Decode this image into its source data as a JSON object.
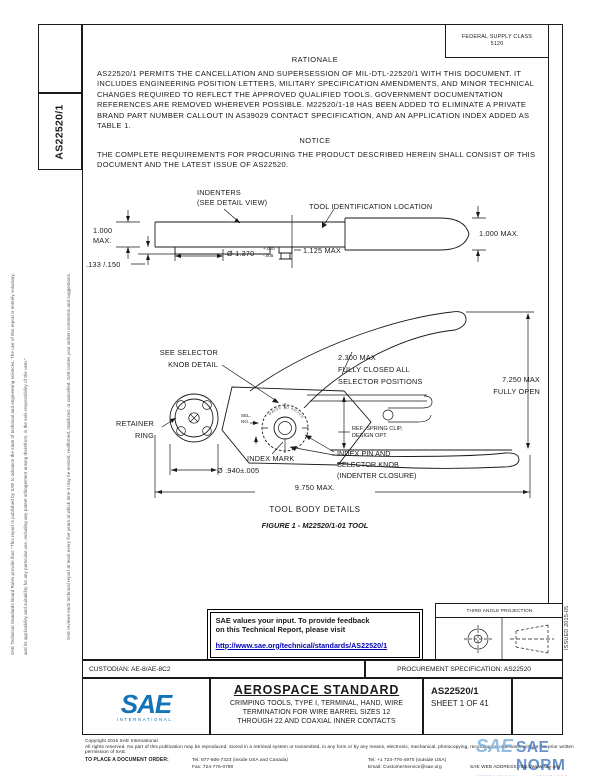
{
  "frame": {
    "fsc": "FEDERAL SUPPLY CLASS\n5120",
    "side_doc_number": "AS22520/1",
    "issued": "ISSUED 2015-05",
    "margin_note_1": "SAE Technical Standards Board Rules provide that: \"This report is published by SAE to advance the state of technical and engineering sciences. The use of this report is entirely voluntary,",
    "margin_note_2": "and its applicability and suitability for any particular use, including any patent infringement arising therefrom, is the sole responsibility of the user.\"",
    "margin_note_3": "SAE reviews each technical report at least every five years at which time it may be revised, reaffirmed, stabilized, or cancelled. SAE invites your written comments and suggestions."
  },
  "rationale": {
    "heading": "RATIONALE",
    "body": "AS22520/1 PERMITS THE CANCELLATION AND SUPERSESSION OF MIL-DTL-22520/1 WITH THIS DOCUMENT.  IT\nINCLUDES ENGINEERING POSITION LETTERS, MILITARY SPECIFICATION AMENDMENTS, AND MINOR TECHNICAL\nCHANGES REQUIRED TO REFLECT THE APPROVED QUALIFIED TOOLS. GOVERNMENT DOCUMENTATION\nREFERENCES ARE REMOVED WHEREVER POSSIBLE. M22520/1-18 HAS BEEN ADDED TO ELIMINATE A PRIVATE\nBRAND PART NUMBER CALLOUT IN AS39029 CONTACT SPECIFICATION, AND AN APPLICATION INDEX ADDED AS\nTABLE 1."
  },
  "notice": {
    "heading": "NOTICE",
    "body": "THE COMPLETE REQUIREMENTS FOR PROCURING THE PRODUCT DESCRIBED HEREIN SHALL CONSIST OF THIS\nDOCUMENT AND THE LATEST ISSUE OF AS22520."
  },
  "figure1": {
    "label_indenters": "INDENTERS\n(SEE DETAIL VIEW)",
    "label_tool_id": "TOOL IDENTIFICATION LOCATION",
    "dim_height_left": "1.000\nMAX.",
    "dim_flange": ".133 /.150",
    "dim_diameter": "Ø 1.370",
    "dim_diameter_tol_upper": "+.000",
    "dim_diameter_tol_lower": "-.005",
    "dim_nut": "1.125 MAX",
    "dim_height_right": "1.000 MAX."
  },
  "figure2": {
    "label_selector_detail": "SEE SELECTOR\nKNOB DETAIL",
    "dim_closed": "2.300 MAX\nFULLY CLOSED ALL\nSELECTOR POSITIONS",
    "dim_open": "7.250 MAX\nFULLY OPEN",
    "label_retainer": "RETAINER\nRING",
    "label_sel_no": "SEL.\nNO.",
    "label_spring_clip": "REF: SPRING CLIP,\nDESIGN OPT.",
    "label_index_mark": "INDEX MARK",
    "label_index_pin": "INDEX PIN AND\nSELECTOR KNOB\n(INDENTER CLOSURE)",
    "dim_ring": "Ø .940±.005",
    "dim_length": "9.750 MAX.",
    "knob_arc_text": "RAISE TO ADJUST",
    "subtitle": "TOOL BODY DETAILS",
    "caption": "FIGURE 1 - M22520/1-01 TOOL"
  },
  "feedback": {
    "line1": "SAE values your input. To provide feedback",
    "line2": "on this Technical Report, please visit",
    "link": "http://www.sae.org/technical/standards/AS22520/1"
  },
  "projection": {
    "label": "THIRD ANGLE PROJECTION"
  },
  "title_block": {
    "custodian": "CUSTODIAN: AE-8/AE-8C2",
    "procurement": "PROCUREMENT SPECIFICATION: AS22520",
    "logo_text": "SAE",
    "logo_sub": "INTERNATIONAL.",
    "standard_type": "AEROSPACE STANDARD",
    "title": "CRIMPING TOOLS, TYPE I, TERMINAL, HAND, WIRE\nTERMINATION FOR WIRE BARREL SIZES 12\nTHROUGH 22 AND COAXIAL INNER CONTACTS",
    "doc_number": "AS22520/1",
    "sheet": "SHEET 1 OF 41"
  },
  "footer": {
    "copyright": "Copyright 2015 SAE International",
    "rights": "All rights reserved. No part of this publication may be reproduced, stored in a retrieval system or transmitted, in any form or by any means, electronic, mechanical, photocopying, recording, or otherwise, without the prior written permission of SAE.",
    "order_label": "TO PLACE A DOCUMENT ORDER:",
    "tel_inside": "Tel: 877-606-7323 (inside USA and Canada)",
    "fax": "Fax: 724-776-0790",
    "tel_outside": "Tel: +1 724-776-4970 (outside USA)",
    "email": "Email: CustomerService@sae.org",
    "web": "SAE WEB ADDRESS: http://www.sae.org"
  },
  "watermark": {
    "brand": "SAE",
    "name": "SAE NORM",
    "sub1": "INTERNATIONAL.",
    "sub2": "— STANDARDS —"
  },
  "colors": {
    "sae_blue": "#1173b8",
    "link_blue": "#0000bb",
    "watermark_blue": "#6e9fd4"
  }
}
